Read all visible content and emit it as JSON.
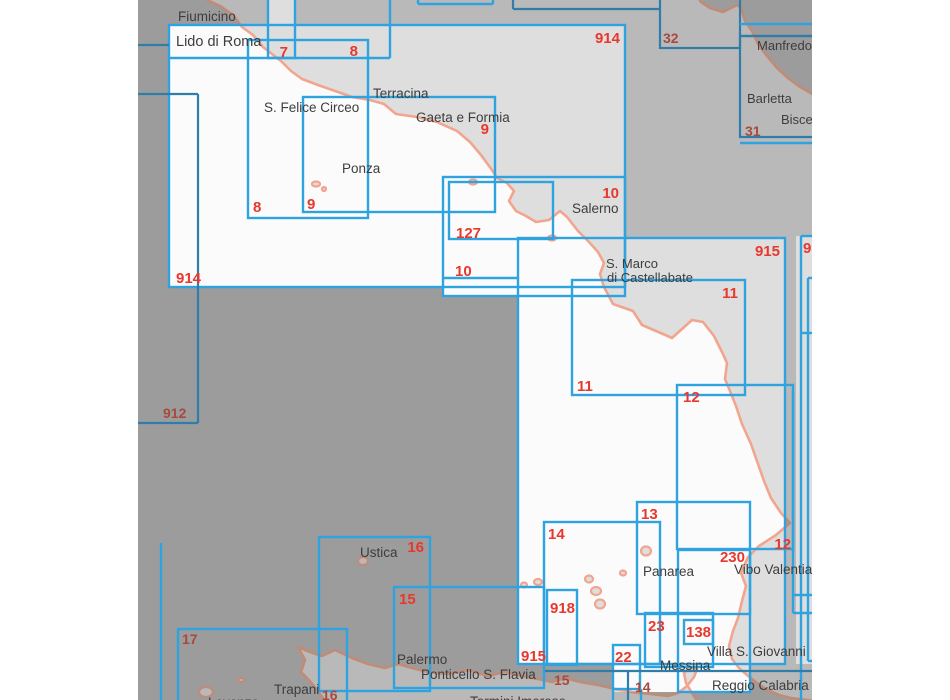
{
  "document": {
    "type": "nautical-chart-index-map",
    "region": "Tyrrhenian Sea - Central and Southern Italy"
  },
  "palette": {
    "page_bg": "#ffffff",
    "sea_dark": "#9c9c9c",
    "land_dark": "#b9b9b9",
    "coast_dark": "#c18b76",
    "sea_light": "#fbfbfb",
    "land_light": "#dedede",
    "coast_light": "#f2a58e",
    "box_bright": "#2fa3e0",
    "box_dark": "#2f7da8",
    "label_bright_red": "#e8382d",
    "label_muted_red": "#a8493f",
    "place_text": "#3d3d3d"
  },
  "map": {
    "strip_x": 138,
    "strip_w": 674,
    "strip_h": 700,
    "land_paths": [
      "M 207,-5 L 207,0 220,6 233,15 242,27 253,35 263,47 272,54 281,61 291,71 302,79 318,85 338,92 352,97 370,100 384,104 396,114 417,117 437,122 457,131 470,142 481,155 492,170 497,178 507,183 514,191 509,201 516,211 526,216 536,222 549,220 560,211 567,217 578,231 589,242 598,252 604,263 600,274 604,287 613,304 633,311 642,325 663,334 672,338 692,320 703,322 714,336 722,352 727,363 725,379 730,391 736,406 742,424 751,444 758,464 764,481 771,498 781,513 790,523 776,535 759,546 748,557 741,573 746,586 742,601 738,618 733,631 729,646 732,659 739,668 747,675 757,683 767,690 779,695 791,698 816,701 L 816,96 800,87 788,78 777,68 767,56 758,44 752,31 745,21 741,8 737,5 723,12 710,8 701,2 697,-5 Z",
      "M 298,647 L 310,652 322,656 335,650 352,658 368,664 385,668 398,664 412,668 428,672 448,674 468,670 488,676 505,672 522,676 538,679 552,682 565,678 580,682 598,685 615,689 632,692 650,694 668,696 678,693 687,686 694,677 697,669 690,667 684,673 686,683 692,693 699,704 L 326,704 323,698 317,690 309,680 301,672 305,660 Z"
    ],
    "islands": [
      {
        "name": "Ustica",
        "cx": 363,
        "cy": 561,
        "rx": 5,
        "ry": 4
      },
      {
        "name": "Levanzo",
        "cx": 206,
        "cy": 692,
        "rx": 7,
        "ry": 5
      },
      {
        "name": "Favignana",
        "cx": 241,
        "cy": 680,
        "rx": 3,
        "ry": 2
      },
      {
        "name": "Ponza",
        "cx": 316,
        "cy": 184,
        "rx": 4,
        "ry": 2.5
      },
      {
        "name": "Zannone",
        "cx": 324,
        "cy": 189,
        "rx": 2,
        "ry": 2
      },
      {
        "name": "Ischia",
        "cx": 473,
        "cy": 182,
        "rx": 4,
        "ry": 2.5
      },
      {
        "name": "Capri",
        "cx": 552,
        "cy": 238,
        "rx": 4,
        "ry": 2.5
      },
      {
        "name": "Alicudi",
        "cx": 524,
        "cy": 585,
        "rx": 3,
        "ry": 2.5
      },
      {
        "name": "Filicudi",
        "cx": 538,
        "cy": 582,
        "rx": 4,
        "ry": 3
      },
      {
        "name": "Salina",
        "cx": 589,
        "cy": 579,
        "rx": 4,
        "ry": 3.5
      },
      {
        "name": "Lipari",
        "cx": 596,
        "cy": 591,
        "rx": 5,
        "ry": 4
      },
      {
        "name": "Vulcano",
        "cx": 600,
        "cy": 604,
        "rx": 5,
        "ry": 4.5
      },
      {
        "name": "Panarea",
        "cx": 623,
        "cy": 573,
        "rx": 3,
        "ry": 2.5
      },
      {
        "name": "Stromboli",
        "cx": 646,
        "cy": 551,
        "rx": 5,
        "ry": 4.5
      }
    ]
  },
  "boxes": [
    {
      "id": "914",
      "x": 169,
      "y": 25,
      "w": 456,
      "h": 262,
      "style": "bright",
      "filled": true,
      "labels": [
        {
          "text": "914",
          "x": 176,
          "y": 283,
          "anchor": "start",
          "variant": "bright"
        },
        {
          "text": "914",
          "x": 620,
          "y": 43,
          "anchor": "end",
          "variant": "bright"
        }
      ]
    },
    {
      "id": "7",
      "x": 268,
      "y": -8,
      "w": 27,
      "h": 66,
      "style": "bright",
      "filled": true,
      "labels": [
        {
          "text": "7",
          "x": 288,
          "y": 57,
          "anchor": "end",
          "variant": "bright"
        }
      ]
    },
    {
      "id": "8",
      "x": 248,
      "y": 40,
      "w": 120,
      "h": 178,
      "style": "bright",
      "filled": true,
      "labels": [
        {
          "text": "8",
          "x": 358,
          "y": 56,
          "anchor": "end",
          "variant": "bright"
        },
        {
          "text": "8",
          "x": 253,
          "y": 212,
          "anchor": "start",
          "variant": "bright"
        }
      ]
    },
    {
      "id": "9",
      "x": 303,
      "y": 97,
      "w": 192,
      "h": 115,
      "style": "bright",
      "filled": true,
      "labels": [
        {
          "text": "9",
          "x": 489,
          "y": 134,
          "anchor": "end",
          "variant": "bright"
        },
        {
          "text": "9",
          "x": 307,
          "y": 209,
          "anchor": "start",
          "variant": "bright"
        }
      ]
    },
    {
      "id": "10",
      "x": 443,
      "y": 177,
      "w": 182,
      "h": 119,
      "style": "bright",
      "filled": true,
      "labels": [
        {
          "text": "10",
          "x": 619,
          "y": 198,
          "anchor": "end",
          "variant": "bright"
        },
        {
          "text": "10",
          "x": 455,
          "y": 276,
          "anchor": "start",
          "variant": "bright"
        }
      ]
    },
    {
      "id": "127",
      "x": 449,
      "y": 182,
      "w": 104,
      "h": 57,
      "style": "bright",
      "filled": true,
      "labels": [
        {
          "text": "127",
          "x": 456,
          "y": 238,
          "anchor": "start",
          "variant": "bright"
        }
      ]
    },
    {
      "id": "915",
      "x": 518,
      "y": 238,
      "w": 267,
      "h": 426,
      "style": "bright",
      "filled": true,
      "labels": [
        {
          "text": "915",
          "x": 780,
          "y": 256,
          "anchor": "end",
          "variant": "bright"
        },
        {
          "text": "915",
          "x": 521,
          "y": 661,
          "anchor": "start",
          "variant": "bright"
        }
      ]
    },
    {
      "id": "11",
      "x": 572,
      "y": 280,
      "w": 173,
      "h": 115,
      "style": "bright",
      "filled": true,
      "labels": [
        {
          "text": "11",
          "x": 738,
          "y": 298,
          "anchor": "end",
          "variant": "bright"
        },
        {
          "text": "11",
          "x": 577,
          "y": 391,
          "anchor": "start",
          "variant": "bright"
        }
      ]
    },
    {
      "id": "12",
      "x": 677,
      "y": 385,
      "w": 116,
      "h": 164,
      "style": "bright",
      "filled": false,
      "labels": [
        {
          "text": "12",
          "x": 683,
          "y": 402,
          "anchor": "start",
          "variant": "bright"
        },
        {
          "text": "12",
          "x": 791,
          "y": 549,
          "anchor": "end",
          "variant": "bright"
        }
      ]
    },
    {
      "id": "13",
      "x": 637,
      "y": 502,
      "w": 113,
      "h": 112,
      "style": "bright",
      "filled": true,
      "labels": [
        {
          "text": "13",
          "x": 641,
          "y": 519,
          "anchor": "start",
          "variant": "bright"
        }
      ]
    },
    {
      "id": "14",
      "x": 544,
      "y": 522,
      "w": 116,
      "h": 142,
      "style": "bright",
      "filled": true,
      "labels": [
        {
          "text": "14",
          "x": 548,
          "y": 539,
          "anchor": "start",
          "variant": "bright"
        }
      ]
    },
    {
      "id": "230",
      "x": 678,
      "y": 550,
      "w": 72,
      "h": 142,
      "style": "bright",
      "filled": true,
      "labels": [
        {
          "text": "230",
          "x": 745,
          "y": 562,
          "anchor": "end",
          "variant": "bright"
        }
      ]
    },
    {
      "id": "918",
      "x": 547,
      "y": 590,
      "w": 30,
      "h": 75,
      "style": "bright",
      "filled": true,
      "labels": [
        {
          "text": "918",
          "x": 550,
          "y": 613,
          "anchor": "start",
          "variant": "bright"
        }
      ]
    },
    {
      "id": "23",
      "x": 645,
      "y": 613,
      "w": 68,
      "h": 54,
      "style": "bright",
      "filled": true,
      "labels": [
        {
          "text": "23",
          "x": 648,
          "y": 631,
          "anchor": "start",
          "variant": "bright"
        }
      ]
    },
    {
      "id": "138",
      "x": 684,
      "y": 620,
      "w": 29,
      "h": 24,
      "style": "bright",
      "filled": true,
      "labels": [
        {
          "text": "138",
          "x": 686,
          "y": 637,
          "anchor": "start",
          "variant": "bright"
        }
      ]
    },
    {
      "id": "22",
      "x": 613,
      "y": 645,
      "w": 27,
      "h": 44,
      "style": "bright",
      "filled": true,
      "labels": [
        {
          "text": "22",
          "x": 615,
          "y": 662,
          "anchor": "start",
          "variant": "bright"
        }
      ]
    },
    {
      "id": "15",
      "x": 394,
      "y": 587,
      "w": 150,
      "h": 101,
      "style": "bright",
      "filled": false,
      "labels": [
        {
          "text": "15",
          "x": 399,
          "y": 604,
          "anchor": "start",
          "variant": "bright"
        }
      ]
    },
    {
      "id": "16",
      "x": 319,
      "y": 537,
      "w": 111,
      "h": 154,
      "style": "bright",
      "filled": false,
      "labels": [
        {
          "text": "16",
          "x": 424,
          "y": 552,
          "anchor": "end",
          "variant": "bright"
        }
      ]
    },
    {
      "id": "17",
      "x": 178,
      "y": 629,
      "w": 169,
      "h": 86,
      "style": "bright",
      "filled": false,
      "labels": [
        {
          "text": "17",
          "x": 182,
          "y": 644,
          "anchor": "start",
          "variant": "muted"
        }
      ]
    },
    {
      "id": "32",
      "x": 660,
      "y": -10,
      "w": 80,
      "h": 58,
      "style": "dark",
      "filled": false,
      "labels": [
        {
          "text": "32",
          "x": 663,
          "y": 43,
          "anchor": "start",
          "variant": "muted"
        }
      ]
    },
    {
      "id": "31",
      "x": 740,
      "y": 36,
      "w": 76,
      "h": 101,
      "style": "dark",
      "filled": false,
      "labels": [
        {
          "text": "31",
          "x": 745,
          "y": 136,
          "anchor": "start",
          "variant": "muted"
        }
      ]
    },
    {
      "id": "right-edge-strip",
      "x": 796,
      "y": 236,
      "w": 20,
      "h": 428,
      "style": "none",
      "filled": true,
      "labels": []
    },
    {
      "id": "strait-helper",
      "x": 613,
      "y": 613,
      "w": 137,
      "h": 79,
      "style": "none",
      "filled": true,
      "labels": []
    }
  ],
  "segments": [
    {
      "x1": 390,
      "y1": 0,
      "x2": 390,
      "y2": 58,
      "style": "bright"
    },
    {
      "x1": 169,
      "y1": 58,
      "x2": 390,
      "y2": 58,
      "style": "bright"
    },
    {
      "x1": 418,
      "y1": 0,
      "x2": 418,
      "y2": 4,
      "style": "bright"
    },
    {
      "x1": 418,
      "y1": 4,
      "x2": 493,
      "y2": 4,
      "style": "bright"
    },
    {
      "x1": 493,
      "y1": 0,
      "x2": 493,
      "y2": 4,
      "style": "bright"
    },
    {
      "x1": 740,
      "y1": 24,
      "x2": 812,
      "y2": 24,
      "style": "bright"
    },
    {
      "x1": 740,
      "y1": 143,
      "x2": 812,
      "y2": 143,
      "style": "bright"
    },
    {
      "x1": 443,
      "y1": 278,
      "x2": 518,
      "y2": 278,
      "style": "bright"
    },
    {
      "x1": 161,
      "y1": 543,
      "x2": 161,
      "y2": 700,
      "style": "bright"
    },
    {
      "x1": 801,
      "y1": 236,
      "x2": 801,
      "y2": 700,
      "style": "bright"
    },
    {
      "x1": 801,
      "y1": 236,
      "x2": 812,
      "y2": 236,
      "style": "bright"
    },
    {
      "x1": 808,
      "y1": 278,
      "x2": 812,
      "y2": 278,
      "style": "bright"
    },
    {
      "x1": 808,
      "y1": 278,
      "x2": 808,
      "y2": 661,
      "style": "bright"
    },
    {
      "x1": 808,
      "y1": 661,
      "x2": 812,
      "y2": 661,
      "style": "bright"
    },
    {
      "x1": 801,
      "y1": 333,
      "x2": 812,
      "y2": 333,
      "style": "bright"
    },
    {
      "x1": 793,
      "y1": 390,
      "x2": 793,
      "y2": 613,
      "style": "bright"
    },
    {
      "x1": 793,
      "y1": 595,
      "x2": 812,
      "y2": 595,
      "style": "bright"
    },
    {
      "x1": 793,
      "y1": 613,
      "x2": 812,
      "y2": 613,
      "style": "bright"
    },
    {
      "x1": 613,
      "y1": 689,
      "x2": 613,
      "y2": 700,
      "style": "bright"
    },
    {
      "x1": 641,
      "y1": 689,
      "x2": 641,
      "y2": 700,
      "style": "bright"
    },
    {
      "x1": 138,
      "y1": 45,
      "x2": 169,
      "y2": 45,
      "style": "dark"
    },
    {
      "x1": 138,
      "y1": 94,
      "x2": 198,
      "y2": 94,
      "style": "dark"
    },
    {
      "x1": 198,
      "y1": 94,
      "x2": 198,
      "y2": 423,
      "style": "dark"
    },
    {
      "x1": 138,
      "y1": 423,
      "x2": 198,
      "y2": 423,
      "style": "dark"
    },
    {
      "x1": 513,
      "y1": 0,
      "x2": 513,
      "y2": 9,
      "style": "dark"
    },
    {
      "x1": 513,
      "y1": 9,
      "x2": 660,
      "y2": 9,
      "style": "dark"
    },
    {
      "x1": 740,
      "y1": 36,
      "x2": 812,
      "y2": 36,
      "style": "dark"
    },
    {
      "x1": 545,
      "y1": 671,
      "x2": 812,
      "y2": 671,
      "style": "dark"
    },
    {
      "x1": 628,
      "y1": 671,
      "x2": 628,
      "y2": 700,
      "style": "dark"
    }
  ],
  "extra_labels": [
    {
      "text": "912",
      "x": 163,
      "y": 418,
      "anchor": "start",
      "variant": "muted"
    },
    {
      "text": "16",
      "x": 322,
      "y": 700,
      "anchor": "start",
      "variant": "muted"
    },
    {
      "text": "15",
      "x": 554,
      "y": 685,
      "anchor": "start",
      "variant": "muted"
    },
    {
      "text": "14",
      "x": 635,
      "y": 692,
      "anchor": "start",
      "variant": "muted"
    },
    {
      "text": "9",
      "x": 803,
      "y": 253,
      "anchor": "start",
      "variant": "bright"
    }
  ],
  "places": [
    {
      "text": "Fiumicino",
      "x": 178,
      "y": 21,
      "size": 13.5
    },
    {
      "text": "Lido di Roma",
      "x": 176,
      "y": 46,
      "size": 14.5
    },
    {
      "text": "S. Felice Circeo",
      "x": 264,
      "y": 112,
      "size": 13.5
    },
    {
      "text": "Terracina",
      "x": 373,
      "y": 98,
      "size": 13.5
    },
    {
      "text": "Gaeta e Formia",
      "x": 416,
      "y": 122,
      "size": 13.5
    },
    {
      "text": "Ponza",
      "x": 342,
      "y": 173,
      "size": 13.5
    },
    {
      "text": "Salerno",
      "x": 572,
      "y": 213,
      "size": 13.5
    },
    {
      "text": "S. Marco",
      "x": 606,
      "y": 268,
      "size": 13
    },
    {
      "text": "di Castellabate",
      "x": 607,
      "y": 282,
      "size": 13
    },
    {
      "text": "Manfredonia",
      "x": 757,
      "y": 50,
      "size": 13
    },
    {
      "text": "Barletta",
      "x": 747,
      "y": 103,
      "size": 13
    },
    {
      "text": "Bisceglie",
      "x": 781,
      "y": 124,
      "size": 13
    },
    {
      "text": "Ustica",
      "x": 360,
      "y": 557,
      "size": 13.5
    },
    {
      "text": "Palermo",
      "x": 397,
      "y": 664,
      "size": 13.5
    },
    {
      "text": "Ponticello S. Flavia",
      "x": 421,
      "y": 679,
      "size": 13.5
    },
    {
      "text": "Termini Imerese",
      "x": 470,
      "y": 706,
      "size": 13.5
    },
    {
      "text": "Trapani",
      "x": 274,
      "y": 694,
      "size": 13.5
    },
    {
      "text": "Levanzo",
      "x": 208,
      "y": 707,
      "size": 13.5
    },
    {
      "text": "Panarea",
      "x": 643,
      "y": 576,
      "size": 13.5
    },
    {
      "text": "Vibo Valentia",
      "x": 734,
      "y": 574,
      "size": 13.5
    },
    {
      "text": "Messina",
      "x": 660,
      "y": 670,
      "size": 13.5
    },
    {
      "text": "Villa S. Giovanni",
      "x": 707,
      "y": 656,
      "size": 13.5
    },
    {
      "text": "Reggio Calabria",
      "x": 712,
      "y": 690,
      "size": 13.5
    }
  ]
}
